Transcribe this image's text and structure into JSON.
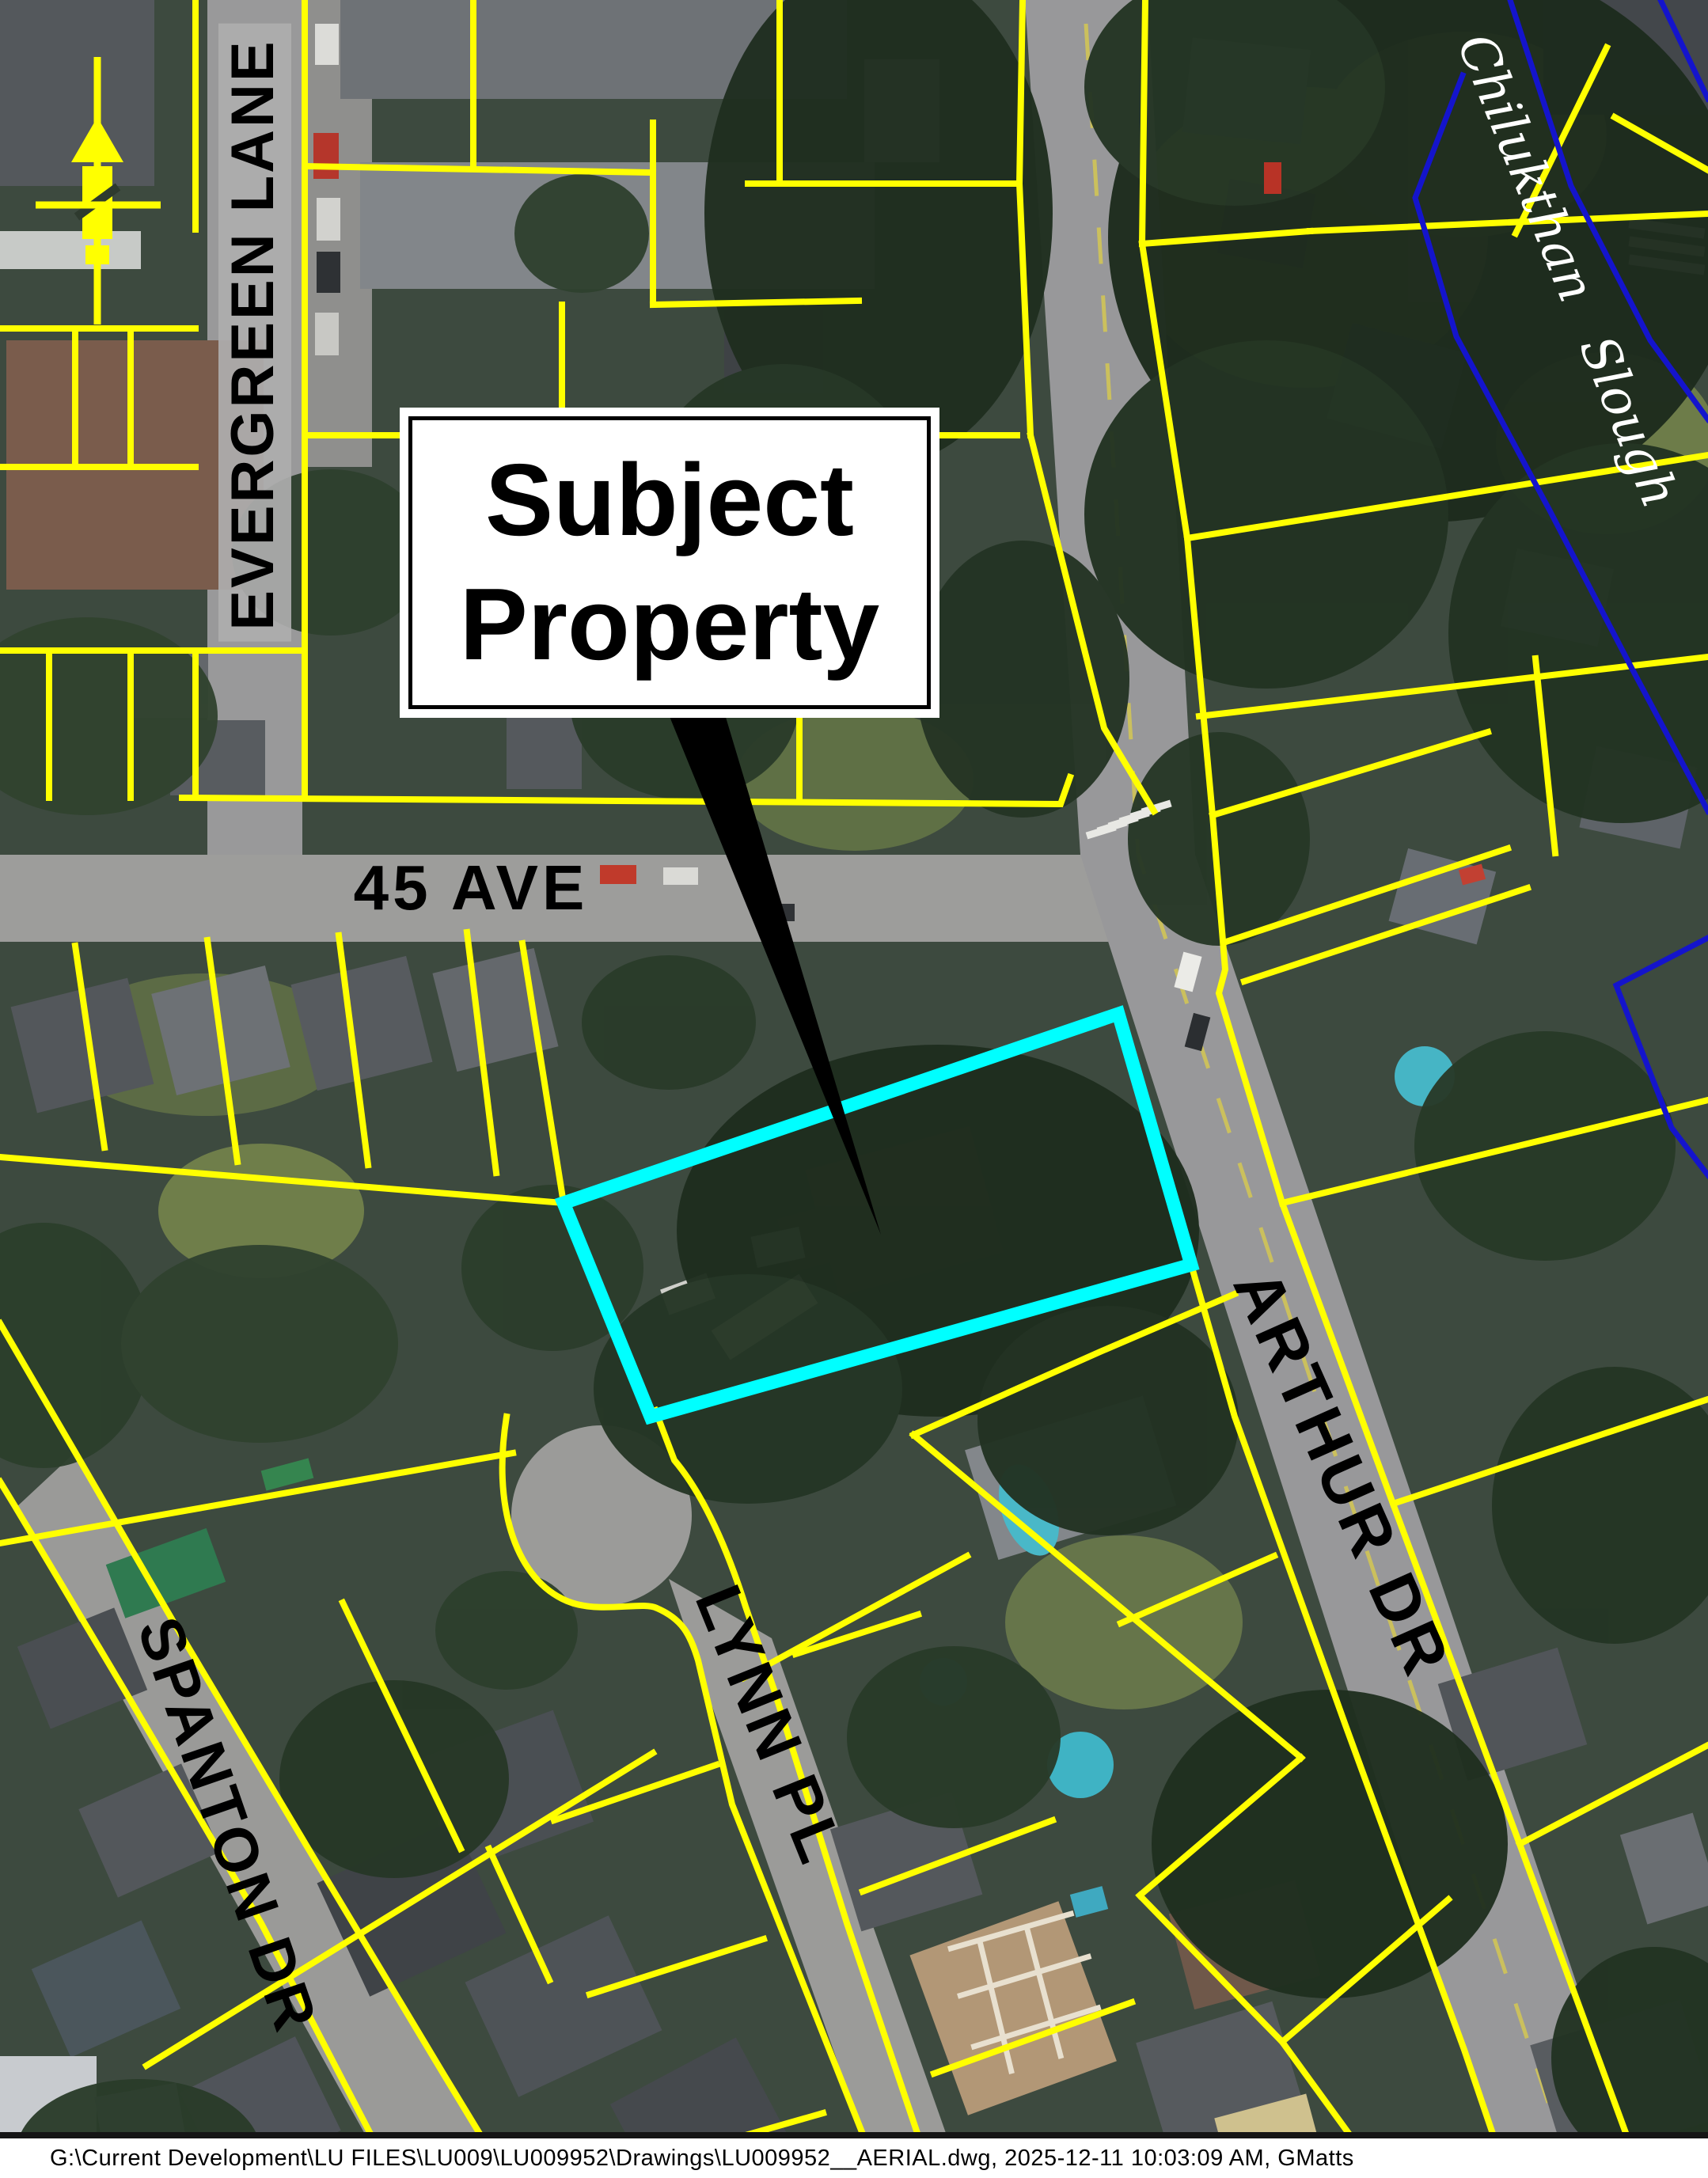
{
  "map": {
    "callout": {
      "line1": "Subject",
      "line2": "Property"
    },
    "labels": {
      "evergreen_lane": "EVERGREEN LANE",
      "forty_five_ave": "45 AVE",
      "arthur_dr": "ARTHUR DR",
      "spanton_dr": "SPANTON DR",
      "lynn_pl": "LYNN PL",
      "chilukthan_slough": "Chilukthan Slough"
    },
    "colors": {
      "subject_boundary": "#00ffff",
      "parcel_line": "#ffff00",
      "water_boundary": "#1414cc",
      "callout_text": "#000000",
      "water_label_text": "#ffffff"
    },
    "icons": {
      "north_arrow": "north-arrow-icon"
    }
  },
  "footer": {
    "path_text": "G:\\Current Development\\LU FILES\\LU009\\LU009952\\Drawings\\LU009952__AERIAL.dwg, 2025-12-11 10:03:09 AM, GMatts"
  }
}
